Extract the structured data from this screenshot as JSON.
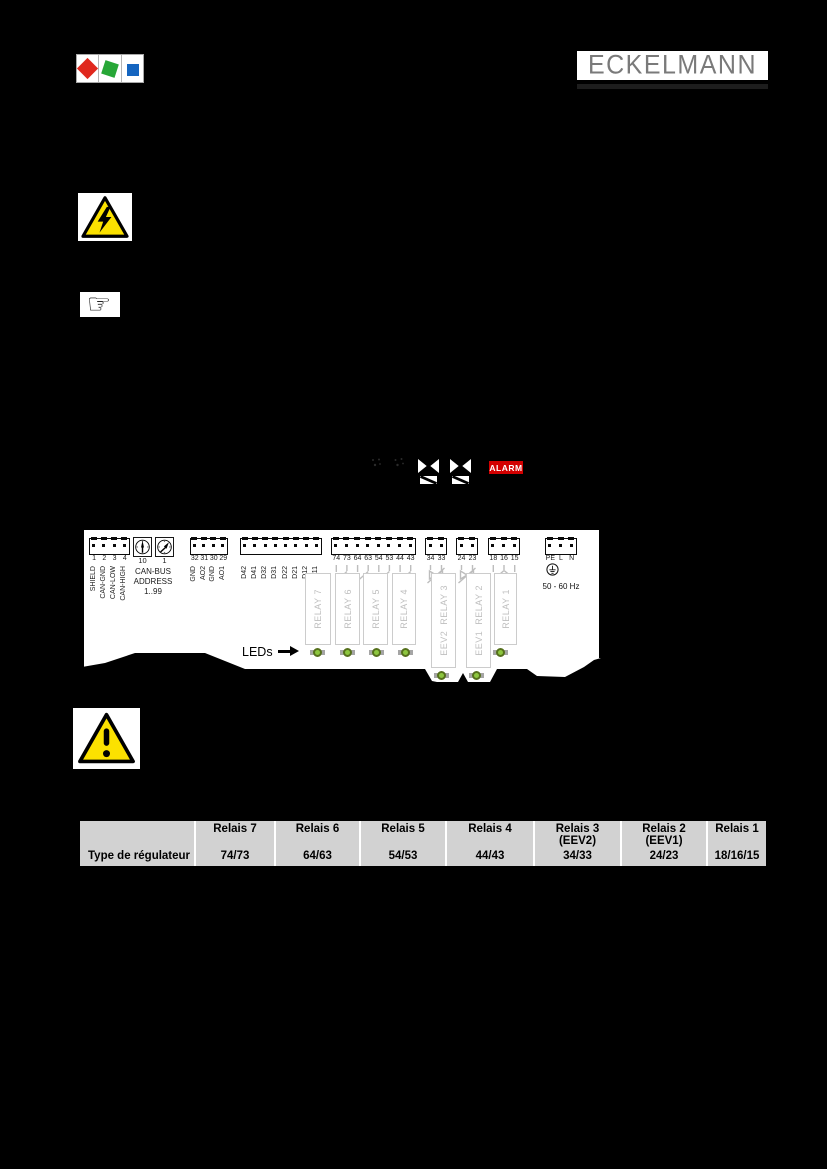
{
  "brand": {
    "company_name": "ECKELMANN",
    "logo_colors": {
      "red": "#e0281e",
      "green": "#27a737",
      "blue": "#1565c0"
    },
    "logo_text_color": "#7a7a7a"
  },
  "icons": {
    "pointing_hand": "☞",
    "warning_yellow": "#fbe100",
    "alarm_red": "#d20000",
    "led_green": "#8dc63f"
  },
  "display": {
    "alarm_label": "ALARM",
    "valve_icon_count": 2
  },
  "device": {
    "leds_label": "LEDs",
    "address": {
      "switch_left_label": "10",
      "switch_right_label": "1",
      "line1": "CAN-BUS",
      "line2": "ADDRESS",
      "line3": "1..99"
    },
    "power": {
      "frequency": "50 - 60 Hz"
    },
    "terminal_groups": [
      {
        "numbers": [
          "1",
          "2",
          "3",
          "4"
        ],
        "labels": [
          "SHIELD",
          "CAN-GND",
          "CAN-LOW",
          "CAN-HIGH"
        ]
      },
      {
        "numbers": [
          "32",
          "31",
          "30",
          "29"
        ],
        "labels": [
          "GND",
          "AO2",
          "GND",
          "AO1"
        ]
      },
      {
        "numbers": [],
        "labels": [
          "D42",
          "D41",
          "D32",
          "D31",
          "D22",
          "D21",
          "D12",
          "D11"
        ]
      },
      {
        "numbers": [
          "74",
          "73",
          "64",
          "63",
          "54",
          "53",
          "44",
          "43"
        ],
        "labels": []
      },
      {
        "numbers": [
          "34",
          "33"
        ],
        "labels": []
      },
      {
        "numbers": [
          "24",
          "23"
        ],
        "labels": []
      },
      {
        "numbers": [
          "18",
          "16",
          "15"
        ],
        "labels": []
      },
      {
        "numbers": [
          "PE",
          "L",
          "N"
        ],
        "labels": []
      }
    ],
    "relays": [
      "RELAY 7",
      "RELAY 6",
      "RELAY 5",
      "RELAY 4",
      "EEV2  RELAY 3",
      "EEV1  RELAY 2",
      "RELAY 1"
    ]
  },
  "table": {
    "row_label": "Type de régulateur",
    "columns": [
      {
        "header": "Relais 7",
        "sub": "",
        "value": "74/73"
      },
      {
        "header": "Relais 6",
        "sub": "",
        "value": "64/63"
      },
      {
        "header": "Relais 5",
        "sub": "",
        "value": "54/53"
      },
      {
        "header": "Relais 4",
        "sub": "",
        "value": "44/43"
      },
      {
        "header": "Relais 3",
        "sub": "(EEV2)",
        "value": "34/33"
      },
      {
        "header": "Relais 2",
        "sub": "(EEV1)",
        "value": "24/23"
      },
      {
        "header": "Relais 1",
        "sub": "",
        "value": "18/16/15"
      }
    ]
  }
}
